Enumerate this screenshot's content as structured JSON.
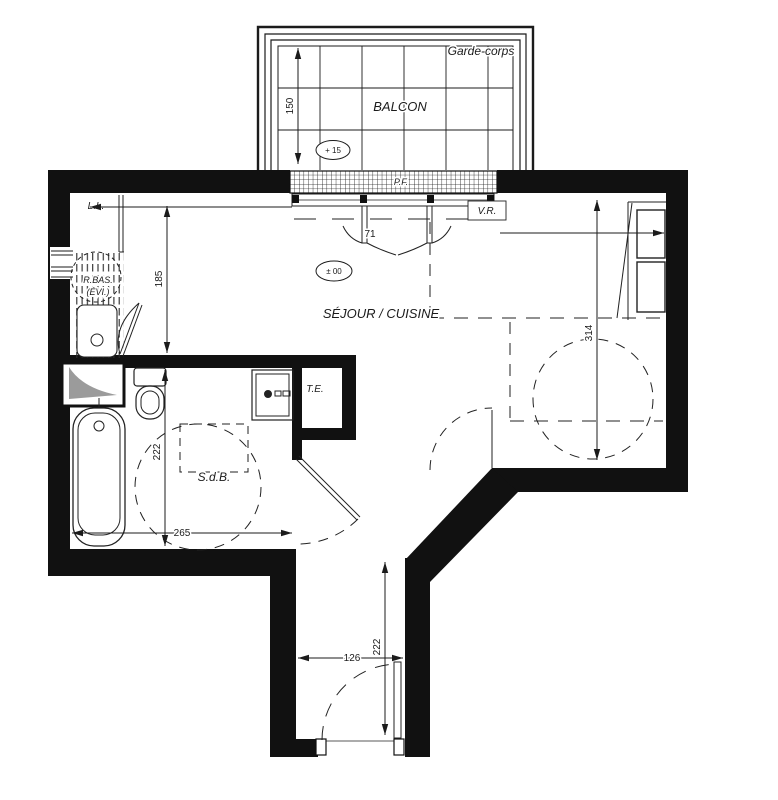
{
  "drawing": {
    "kind": "apartment-floor-plan"
  },
  "labels": {
    "balcony": "BALCON",
    "guardrail": "Garde-corps",
    "living_kitchen": "SÉJOUR / CUISINE",
    "bathroom": "S.d.B.",
    "electrical_panel": "T.E.",
    "washing_machine": "L.L.",
    "roller_shutter": "V.R.",
    "french_window": "P.F.",
    "kitchen_unit": "R.BAS.",
    "kitchen_unit_sub": "(ÉVI.)",
    "level_balcony": "+ 15",
    "level_interior": "± 00",
    "door_width": "71"
  },
  "dimensions": {
    "balcony_depth": "150",
    "kitchen_depth": "185",
    "bathroom_depth": "222",
    "bathroom_width": "265",
    "living_depth": "314",
    "entry_depth": "222",
    "entry_width": "126"
  },
  "colors": {
    "wall": "#111111",
    "line": "#222222",
    "duct_fill": "#9b9b9b",
    "background": "#ffffff"
  }
}
